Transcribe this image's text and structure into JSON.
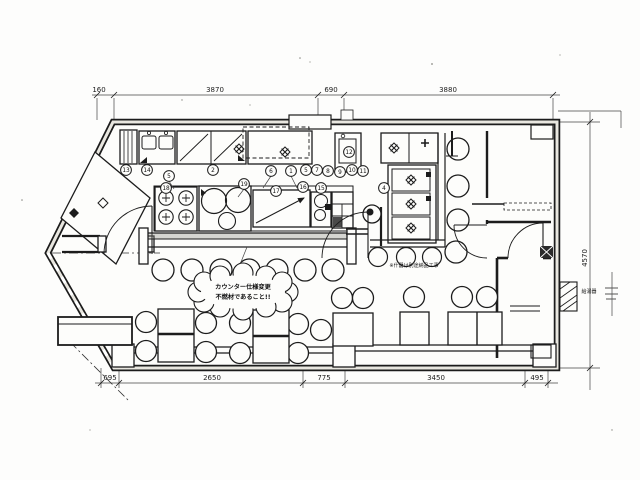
{
  "drawing": {
    "dim_top": [
      "160",
      "3870",
      "690",
      "3880"
    ],
    "dim_bottom": [
      "695",
      "2650",
      "775",
      "3450",
      "495"
    ],
    "dim_right": [
      "4570"
    ],
    "cloud_note": {
      "line1": "カウンター仕様変更",
      "line2": "不燃材であること!!"
    },
    "notes": {
      "fixtures": "※什器は別途納品工事",
      "water_heater": "給湯器"
    },
    "callouts_top": [
      "13",
      "14",
      "5",
      "2",
      "6",
      "1",
      "5",
      "7",
      "8",
      "9",
      "10",
      "11"
    ],
    "callouts_island": [
      "18",
      "19",
      "17",
      "16",
      "15"
    ],
    "callouts_misc": [
      "12",
      "4"
    ]
  }
}
